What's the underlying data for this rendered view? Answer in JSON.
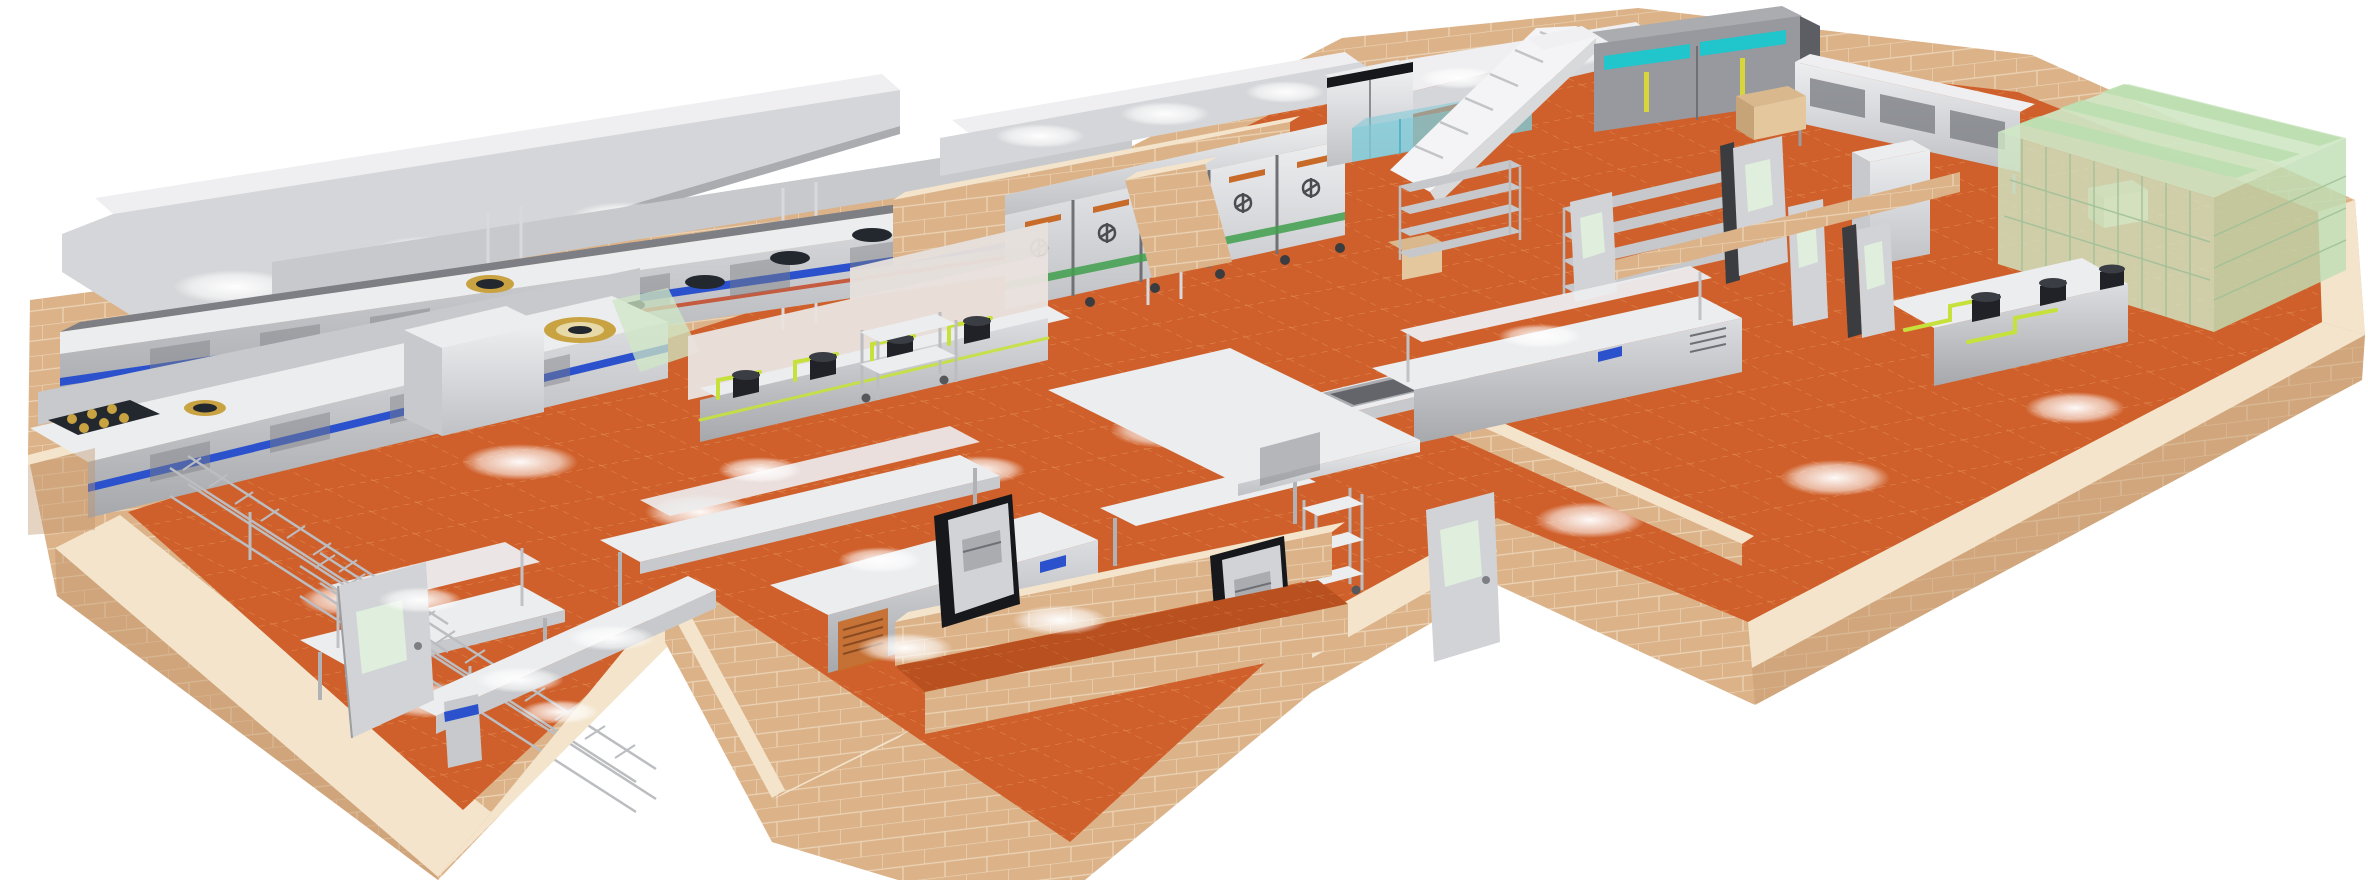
{
  "scene": {
    "type": "3d-isometric-render",
    "subject": "commercial-kitchen-floor-plan"
  },
  "colors": {
    "background": "#ffffff",
    "floor": "#cf602b",
    "floor_dark": "#b8511f",
    "floor_line": "#efae72",
    "wall_face": "#dcb289",
    "wall_top": "#f3e4cb",
    "wall_side": "#c1946a",
    "wall_grout": "#ecd9bc",
    "steel_top": "#ecedef",
    "steel_face": "#c7c9cc",
    "steel_mid": "#aaacb0",
    "steel_dark": "#7d7f84",
    "hood_face": "#d5d6d9",
    "hood_top": "#efeff1",
    "stripe_blue": "#2b52cc",
    "stripe_red": "#c4401c",
    "burner_gold": "#c9a341",
    "burner_dark": "#23272e",
    "pipe_green": "#c6e13c",
    "glass_green": "#cfe7c6",
    "glass_green_stripe": "#bcdfb0",
    "glass_green_face": "#c0deb5",
    "glass_aqua": "#7ecbd8",
    "freezer_teal": "#20c6cc",
    "handle_yellow": "#d8d63a",
    "label_orange": "#c86a28",
    "band_green": "#3f9f4c",
    "dark_box": "#17181b",
    "door_face": "#d2d3d6",
    "door_window": "#dfeedd",
    "chrome": "#bbbdc0",
    "pot_black": "#202228",
    "cardboard": "#d9b88e"
  },
  "equipment": [
    "exhaust-hood",
    "wok-cooking-line",
    "gas-burner-range",
    "stock-pot-burner",
    "rice-steamer-cabinets",
    "upright-refrigerator",
    "upright-freezers",
    "staircase",
    "aqua-glass-partition",
    "wall-cabinets",
    "green-glass-enclosure",
    "wire-shelving",
    "work-tables",
    "overshelf-tables",
    "refrigerated-counters",
    "sink-table",
    "wok-stations",
    "service-counter",
    "dumbwaiters",
    "service-trolleys",
    "pot-rack-runs",
    "hinged-doors",
    "tiled-walls",
    "quarry-tile-floor",
    "storage-boxes",
    "cabinet-counters"
  ]
}
